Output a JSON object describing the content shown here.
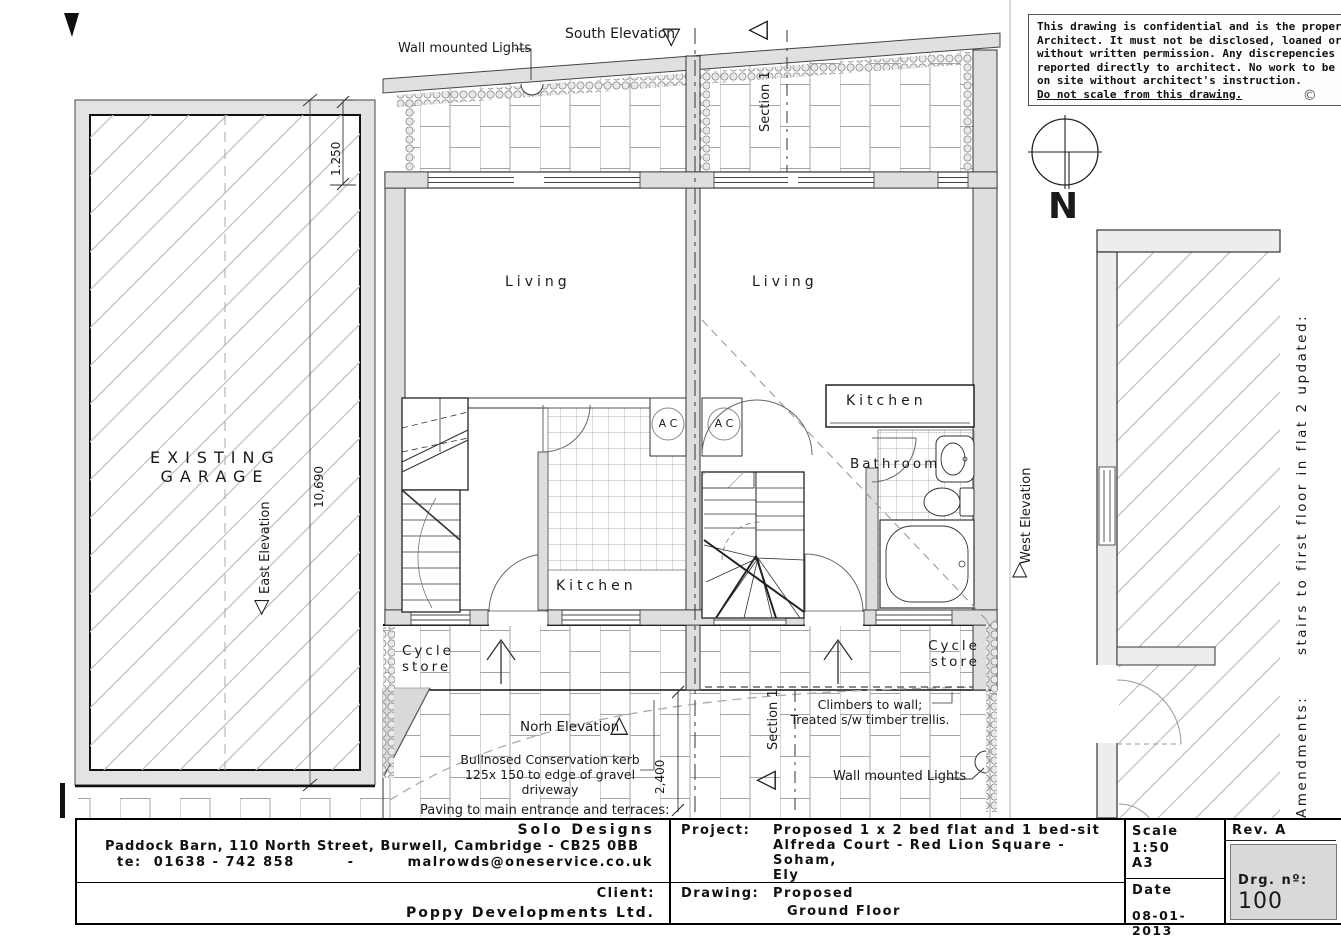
{
  "palette": {
    "wall_fill": "#dedede",
    "line": "#222222",
    "hatch_line": "#bfbfbf",
    "paving_line": "#a5a5a5",
    "drg_box_fill": "#d9d9d9"
  },
  "icons": {
    "triangle_down": "▽",
    "triangle_up": "△",
    "triangle_left": "◁",
    "copyright": "©"
  },
  "notice": {
    "lines": [
      "This drawing is confidential and is the property of the",
      "Architect. It must not be disclosed, loaned or copied",
      "without written permission. Any discrepencies to be",
      "reported directly to architect. No work to be carried",
      "on site without architect's instruction.",
      "Do not scale from this drawing."
    ]
  },
  "compass": {
    "north_label": "N"
  },
  "garage": {
    "name_line1": "EXISTING",
    "name_line2": "GARAGE",
    "east_elevation": "East Elevation",
    "dim_width": "1.250",
    "dim_length": "10,690"
  },
  "plan": {
    "south_elevation": "South Elevation",
    "north_elevation": "Norh Elevation",
    "west_elevation": "West Elevation",
    "section_label": "Section 1",
    "wall_lights": "Wall mounted Lights",
    "living": "Living",
    "kitchen": "Kitchen",
    "bathroom": "Bathroom",
    "ac": "A C",
    "cycle_line1": "Cycle",
    "cycle_line2": "store",
    "climbers_line1": "Climbers to wall;",
    "climbers_line2": "Treated s/w timber trellis.",
    "kerb_line1": "Bullnosed Conservation kerb",
    "kerb_line2": "125x 150 to edge of gravel driveway",
    "paving_note": "Paving to main entrance and terraces:",
    "dim_path": "2,400"
  },
  "amendments": {
    "text": "Amendments:      stairs to first floor in flat 2 updated:"
  },
  "title_block": {
    "company": "Solo Designs",
    "address": "Paddock Barn, 110 North Street, Burwell, Cambridge - CB25 0BB",
    "tel": "te:  01638 - 742 858",
    "sep": "-",
    "email": "malrowds@oneservice.co.uk",
    "client_label": "Client:",
    "client": "Poppy Developments Ltd.",
    "project_label": "Project:",
    "project_line1": "Proposed 1 x 2 bed flat and 1 bed-sit",
    "project_line2": "Alfreda Court - Red Lion Square - Soham,",
    "project_line3": "Ely",
    "drawing_label": "Drawing:",
    "drawing_line1": "Proposed",
    "drawing_line2": "Ground Floor",
    "scale_label": "Scale",
    "scale": "1:50",
    "paper": "A3",
    "date_label": "Date",
    "date": "08-01-2013",
    "rev": "Rev. A",
    "drg_label": "Drg. nº:",
    "drg_no": "100"
  }
}
